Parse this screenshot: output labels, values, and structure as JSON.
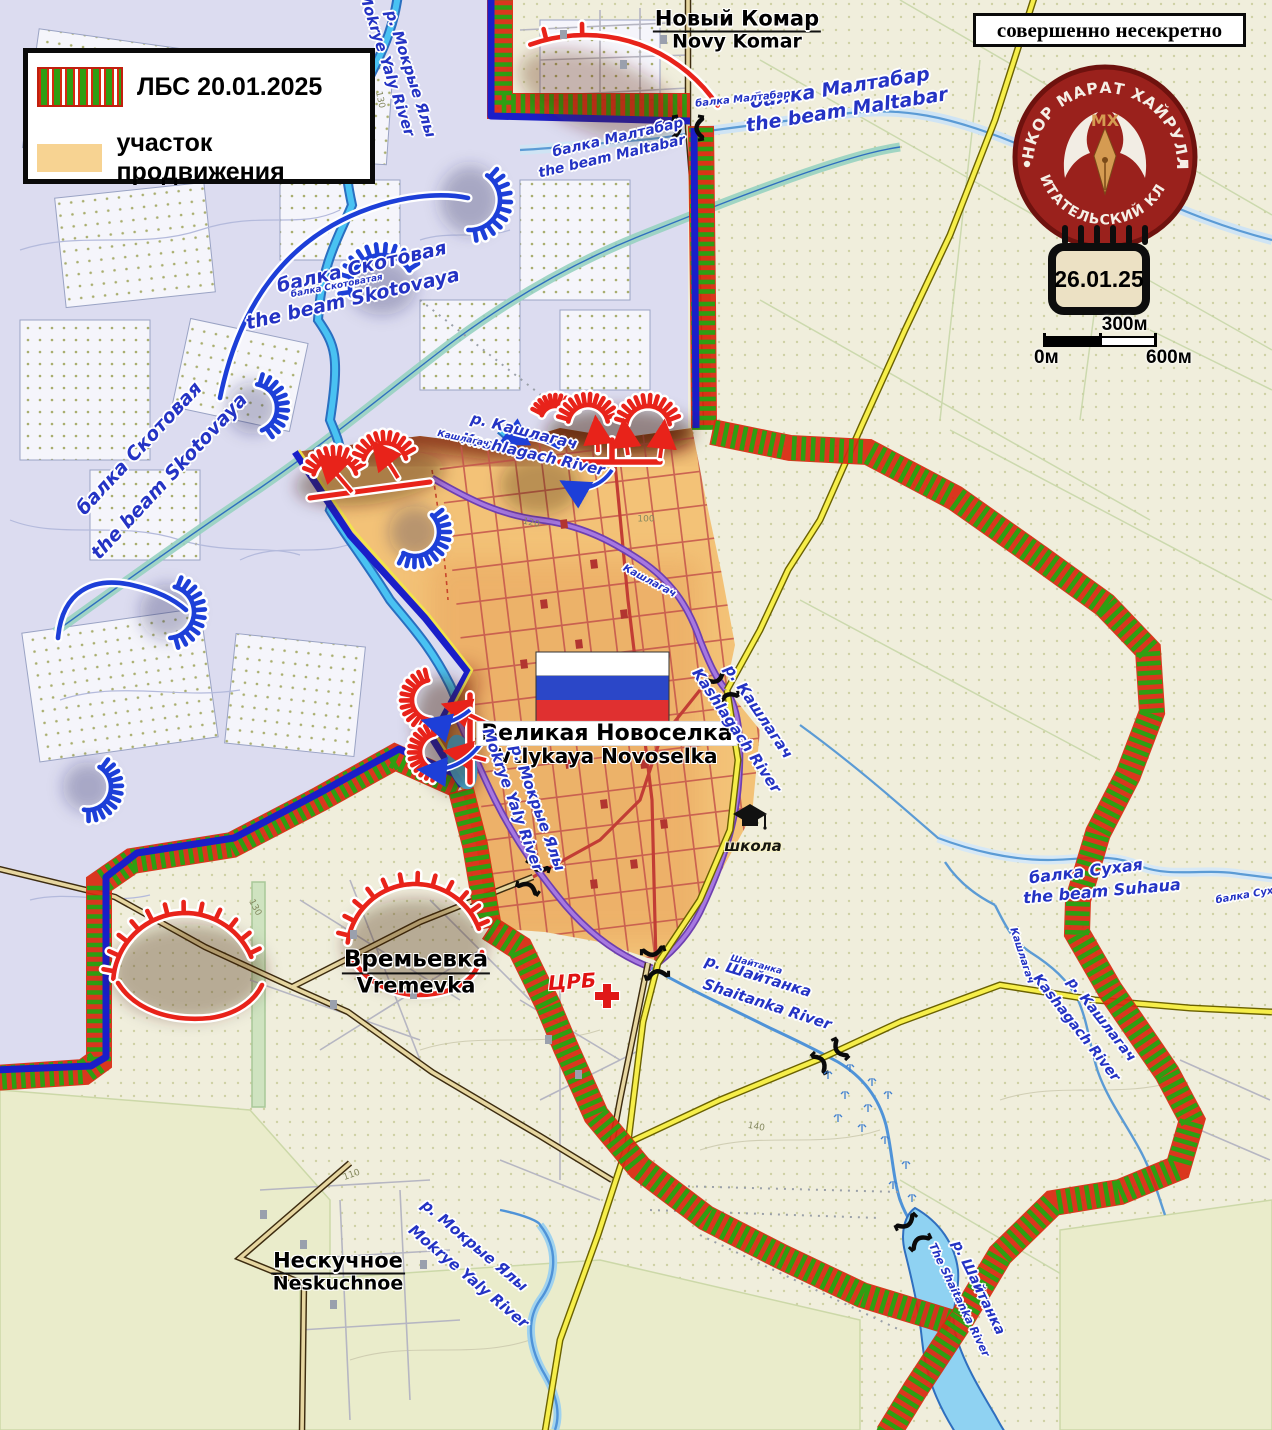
{
  "legend": {
    "lbs_label": "ЛБС 20.01.2025",
    "advance_label": "участок продвижения"
  },
  "banner": {
    "text": "совершенно несекретно"
  },
  "logo": {
    "arc_top": "ВОЕНКОР МАРАТ ХАЙРУЛЛИН",
    "arc_bottom": "ЧИТАТЕЛЬСКИЙ КЛУБ",
    "monogram": "МХ"
  },
  "calendar": {
    "date": "26.01.25"
  },
  "scale_bar": {
    "mid": "300м",
    "start": "0м",
    "end": "600м"
  },
  "places": {
    "novy_komar": {
      "ru": "Новый Комар",
      "en": "Novy Komar"
    },
    "velyka_novoselka": {
      "ru": "Великая Новоселка",
      "en": "Vtlykaya Novoselka"
    },
    "vremevka": {
      "ru": "Времьевка",
      "en": "Vremevka"
    },
    "neskuchnoe": {
      "ru": "Нескучное",
      "en": "Neskuchnoe"
    }
  },
  "poi": {
    "hospital": "ЦРБ",
    "school": "школа"
  },
  "colors": {
    "front_red": "#e8231a",
    "front_green": "#2f9e12",
    "blue_line": "#1a1ec8",
    "advance_fill": "#f3c277",
    "advance_swatch": "#f7d392",
    "logo_red": "#9a211c"
  },
  "map_labels": [
    {
      "t": "Новый Комар",
      "t2": "Novy Komar",
      "x": 737,
      "y": 30,
      "s": 21,
      "cls": "place"
    },
    {
      "t": "Времьевка",
      "t2": "Vremevka",
      "x": 416,
      "y": 972,
      "s": 23,
      "cls": "place"
    },
    {
      "t": "Нескучное",
      "t2": "Neskuchnoe",
      "x": 338,
      "y": 1272,
      "s": 21,
      "cls": "place"
    },
    {
      "t": "Великая Новоселка",
      "t2": "Vtlykaya Novoselka",
      "x": 607,
      "y": 744,
      "s": 22,
      "cls": "place-hl"
    },
    {
      "t": "балка Малтабар",
      "x": 618,
      "y": 138,
      "r": -13,
      "s": 14,
      "cls": "river"
    },
    {
      "t": "the beam Maltabar",
      "x": 612,
      "y": 157,
      "r": -13,
      "s": 14,
      "cls": "river"
    },
    {
      "t": "балка Малтабар",
      "x": 840,
      "y": 89,
      "r": -9,
      "s": 19,
      "cls": "river"
    },
    {
      "t": "the beam Maltabar",
      "x": 847,
      "y": 111,
      "r": -9,
      "s": 19,
      "cls": "river"
    },
    {
      "t": "балка Малтабар",
      "x": 743,
      "y": 100,
      "r": -6,
      "s": 10,
      "cls": "river"
    },
    {
      "t": "балка Скотовая",
      "x": 362,
      "y": 268,
      "r": -13,
      "s": 19,
      "cls": "river"
    },
    {
      "t": "the beam  Skotovaya",
      "x": 353,
      "y": 300,
      "r": -13,
      "s": 19,
      "cls": "river"
    },
    {
      "t": "балка Скотоватая",
      "x": 337,
      "y": 287,
      "r": -11,
      "s": 9,
      "cls": "river"
    },
    {
      "t": "балка Скотовая",
      "x": 140,
      "y": 449,
      "r": -47,
      "s": 19,
      "cls": "river"
    },
    {
      "t": "the beam Skotovaya",
      "x": 170,
      "y": 477,
      "r": -47,
      "s": 19,
      "cls": "river"
    },
    {
      "t": "р. Мокрые Ялы",
      "x": 410,
      "y": 74,
      "r": 72,
      "s": 15,
      "cls": "river"
    },
    {
      "t": "Mokrye Yaly River",
      "x": 386,
      "y": 64,
      "r": 72,
      "s": 15,
      "cls": "river"
    },
    {
      "t": "р. Мокрые Ялы",
      "x": 537,
      "y": 808,
      "r": 70,
      "s": 15,
      "cls": "river"
    },
    {
      "t": "Mokrye Yaly River",
      "x": 512,
      "y": 800,
      "r": 70,
      "s": 15,
      "cls": "river"
    },
    {
      "t": "р. Мокрые Ялы",
      "x": 474,
      "y": 1246,
      "r": 40,
      "s": 15,
      "cls": "river"
    },
    {
      "t": "Mokrye Yaly River",
      "x": 468,
      "y": 1277,
      "r": 40,
      "s": 15,
      "cls": "river"
    },
    {
      "t": "р. Кашлагач",
      "x": 524,
      "y": 432,
      "r": 14,
      "s": 15,
      "cls": "river"
    },
    {
      "t": "Kashlagach River",
      "x": 533,
      "y": 455,
      "r": 13,
      "s": 15,
      "cls": "river"
    },
    {
      "t": "р. Кашлагач",
      "x": 758,
      "y": 712,
      "r": 56,
      "s": 15,
      "cls": "river"
    },
    {
      "t": "Kashlagach River",
      "x": 736,
      "y": 731,
      "r": 56,
      "s": 15,
      "cls": "river"
    },
    {
      "t": "р. Кашлагач",
      "x": 1101,
      "y": 1020,
      "r": 52,
      "s": 14,
      "cls": "river"
    },
    {
      "t": "Kashagach River",
      "x": 1076,
      "y": 1028,
      "r": 52,
      "s": 14,
      "cls": "river"
    },
    {
      "t": "р. Шайтанка",
      "x": 758,
      "y": 977,
      "r": 17,
      "s": 15,
      "cls": "river"
    },
    {
      "t": "Shaitanka River",
      "x": 767,
      "y": 1005,
      "r": 18,
      "s": 15,
      "cls": "river"
    },
    {
      "t": "р. Шайтанка",
      "x": 978,
      "y": 1288,
      "r": 64,
      "s": 14,
      "cls": "river"
    },
    {
      "t": "The Shaitanka River",
      "x": 959,
      "y": 1300,
      "r": 64,
      "s": 11,
      "cls": "river"
    },
    {
      "t": "балка Сухая",
      "x": 1086,
      "y": 872,
      "r": -7,
      "s": 16,
      "cls": "river"
    },
    {
      "t": "the beam Suhaua",
      "x": 1102,
      "y": 892,
      "r": -5,
      "s": 16,
      "cls": "river"
    },
    {
      "t": "балка Суха",
      "x": 1248,
      "y": 896,
      "r": -10,
      "s": 10,
      "cls": "river"
    },
    {
      "t": "Кашлагач",
      "x": 649,
      "y": 582,
      "r": 28,
      "s": 10,
      "cls": "river"
    },
    {
      "t": "Кашлагач",
      "x": 1021,
      "y": 956,
      "r": 72,
      "s": 10,
      "cls": "river"
    },
    {
      "t": "Кашлагач",
      "x": 463,
      "y": 440,
      "r": 12,
      "s": 9,
      "cls": "river"
    },
    {
      "t": "Шайтанка",
      "x": 756,
      "y": 966,
      "r": 15,
      "s": 9,
      "cls": "river"
    },
    {
      "t": "ЦРБ",
      "x": 572,
      "y": 982,
      "r": -4,
      "s": 20,
      "cls": "hospital"
    },
    {
      "t": "школа",
      "x": 753,
      "y": 847,
      "r": 0,
      "s": 15,
      "cls": "dark"
    },
    {
      "t": "130",
      "x": 379,
      "y": 100,
      "r": 78,
      "s": 9,
      "cls": "contour"
    },
    {
      "t": "130",
      "x": 1103,
      "y": 243,
      "r": 0,
      "s": 9,
      "cls": "contour"
    },
    {
      "t": "120",
      "x": 531,
      "y": 524,
      "r": 12,
      "s": 9,
      "cls": "contour"
    },
    {
      "t": "130",
      "x": 254,
      "y": 908,
      "r": 62,
      "s": 9,
      "cls": "contour"
    },
    {
      "t": "140",
      "x": 756,
      "y": 1128,
      "r": 10,
      "s": 9,
      "cls": "contour"
    },
    {
      "t": "110",
      "x": 352,
      "y": 1176,
      "r": -20,
      "s": 9,
      "cls": "contour"
    },
    {
      "t": "100",
      "x": 646,
      "y": 520,
      "r": 0,
      "s": 9,
      "cls": "contour"
    }
  ]
}
